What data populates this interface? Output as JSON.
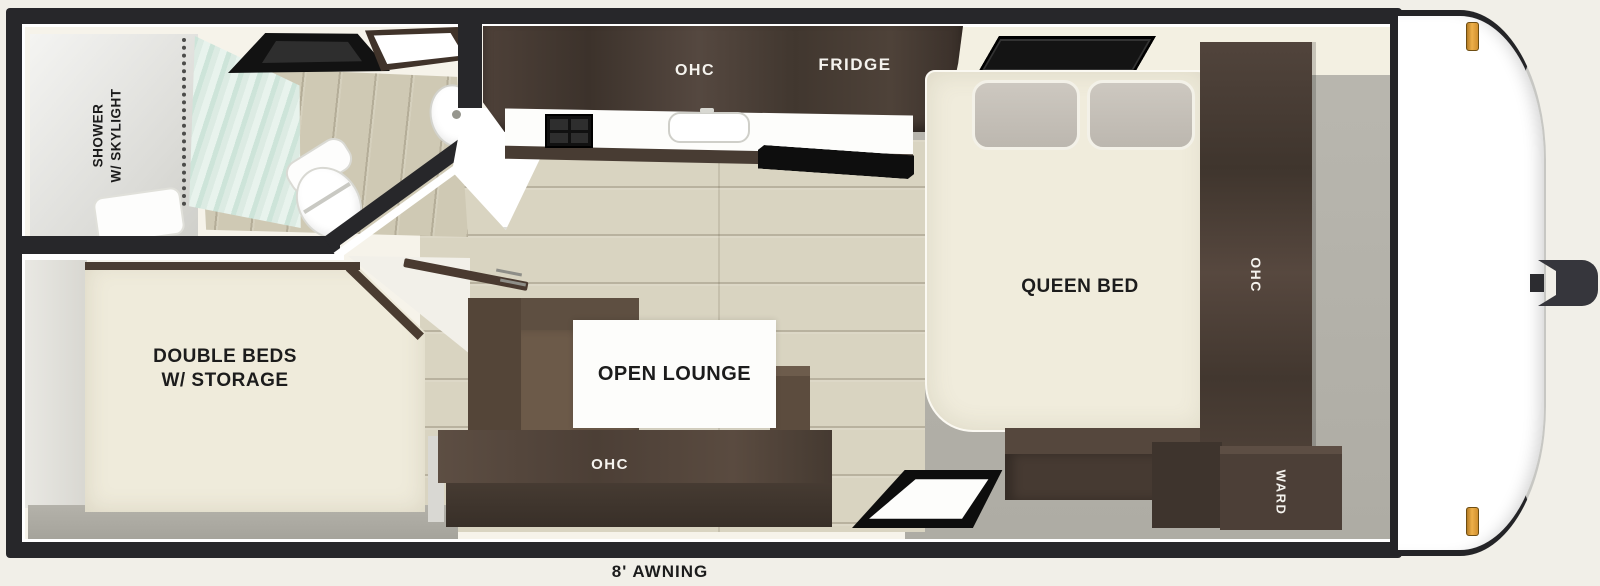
{
  "floorplan": {
    "awning_label": "8' AWNING",
    "bathroom": {
      "label_line1": "SHOWER",
      "label_line2": "W/ SKYLIGHT"
    },
    "kitchen": {
      "ohc_label": "OHC",
      "fridge_label": "FRIDGE"
    },
    "rear_bedroom": {
      "label_line1": "DOUBLE BEDS",
      "label_line2": "W/ STORAGE"
    },
    "lounge": {
      "label": "OPEN LOUNGE",
      "ohc_label": "OHC"
    },
    "front_bedroom": {
      "label": "QUEEN BED",
      "ohc_label": "OHC",
      "ward_label": "WARD"
    },
    "colors": {
      "page_background": "#f1efe8",
      "trailer_wall": "#27272a",
      "interior_wall": "#f6f3ea",
      "cabinet_wood_dark": "#4a3d34",
      "mattress_cream": "#f0ecdc",
      "pillow_gray": "#c5c0b8",
      "floor_wood": "#d9d4c1",
      "floor_gray": "#b1afa7",
      "sofa_brown": "#6c5a49",
      "shower_curtain_mint": "#d8eae0",
      "marker_light_amber": "#eeb04a",
      "fixture_black": "#121212"
    }
  }
}
